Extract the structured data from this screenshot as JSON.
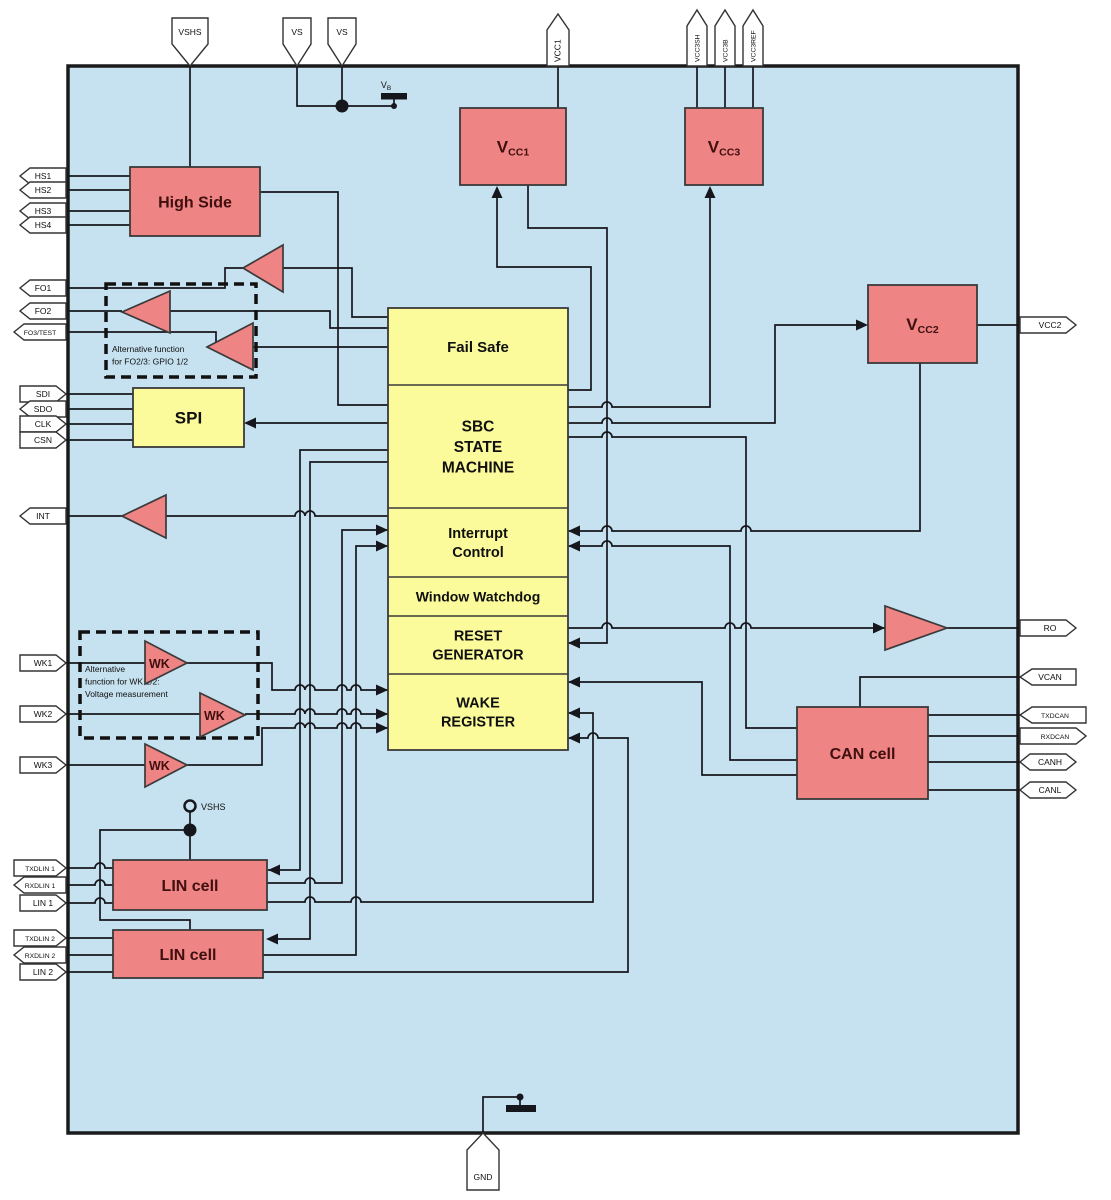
{
  "title": "SBC block diagram",
  "colors": {
    "background": "#ffffff",
    "chip_fill": "#c6e1ef",
    "chip_border": "#1a1a1a",
    "analog_block_fill": "#ee8484",
    "logic_block_fill": "#fbfb9b",
    "block_border": "#3a3a3a",
    "wire": "#16161d",
    "analog_label": "#400f0f",
    "logic_label": "#101010",
    "pin_fill": "#ffffff",
    "pin_border": "#333333"
  },
  "chip": {
    "x": 68,
    "y": 66,
    "w": 950,
    "h": 1067
  },
  "pins": {
    "top": [
      {
        "label": "VSHS",
        "x": 190,
        "tip": "down",
        "small": false
      },
      {
        "label": "VS",
        "x": 297,
        "tip": "down",
        "small": false
      },
      {
        "label": "VS",
        "x": 342,
        "tip": "down",
        "small": false
      },
      {
        "label": "VCC1",
        "x": 558,
        "tip": "up",
        "small": false
      },
      {
        "label": "VCC3SH",
        "x": 697,
        "tip": "up",
        "small": true
      },
      {
        "label": "VCC3B",
        "x": 725,
        "tip": "up",
        "small": true
      },
      {
        "label": "VCC3REF",
        "x": 753,
        "tip": "up",
        "small": true
      }
    ],
    "bottom": [
      {
        "label": "GND",
        "x": 483
      }
    ],
    "left": [
      {
        "label": "HS1",
        "y": 176,
        "tip": "left",
        "small": false
      },
      {
        "label": "HS2",
        "y": 190,
        "tip": "left",
        "small": false
      },
      {
        "label": "HS3",
        "y": 211,
        "tip": "left",
        "small": false
      },
      {
        "label": "HS4",
        "y": 225,
        "tip": "left",
        "small": false
      },
      {
        "label": "FO1",
        "y": 288,
        "tip": "left",
        "small": false
      },
      {
        "label": "FO2",
        "y": 311,
        "tip": "left",
        "small": false
      },
      {
        "label": "FO3/TEST",
        "y": 332,
        "tip": "left",
        "small": true
      },
      {
        "label": "SDI",
        "y": 394,
        "tip": "right",
        "small": false
      },
      {
        "label": "SDO",
        "y": 409,
        "tip": "left",
        "small": false
      },
      {
        "label": "CLK",
        "y": 424,
        "tip": "right",
        "small": false
      },
      {
        "label": "CSN",
        "y": 440,
        "tip": "right",
        "small": false
      },
      {
        "label": "INT",
        "y": 516,
        "tip": "left",
        "small": false
      },
      {
        "label": "WK1",
        "y": 663,
        "tip": "right",
        "small": false
      },
      {
        "label": "WK2",
        "y": 714,
        "tip": "right",
        "small": false
      },
      {
        "label": "WK3",
        "y": 765,
        "tip": "right",
        "small": false
      },
      {
        "label": "TXDLIN 1",
        "y": 868,
        "tip": "right",
        "small": true
      },
      {
        "label": "RXDLIN 1",
        "y": 885,
        "tip": "left",
        "small": true
      },
      {
        "label": "LIN 1",
        "y": 903,
        "tip": "right",
        "small": false
      },
      {
        "label": "TXDLIN 2",
        "y": 938,
        "tip": "right",
        "small": true
      },
      {
        "label": "RXDLIN 2",
        "y": 955,
        "tip": "left",
        "small": true
      },
      {
        "label": "LIN 2",
        "y": 972,
        "tip": "right",
        "small": false
      }
    ],
    "right": [
      {
        "label": "VCC2",
        "y": 325,
        "tip": "right",
        "small": false
      },
      {
        "label": "RO",
        "y": 628,
        "tip": "right",
        "small": false
      },
      {
        "label": "VCAN",
        "y": 677,
        "tip": "left",
        "small": false
      },
      {
        "label": "TXDCAN",
        "y": 715,
        "tip": "left",
        "small": true
      },
      {
        "label": "RXDCAN",
        "y": 736,
        "tip": "right",
        "small": true
      },
      {
        "label": "CANH",
        "y": 762,
        "tip": "both",
        "small": false
      },
      {
        "label": "CANL",
        "y": 790,
        "tip": "both",
        "small": false
      }
    ]
  },
  "blocks": [
    {
      "id": "high-side",
      "label": "High Side",
      "x": 130,
      "y": 167,
      "w": 130,
      "h": 69,
      "type": "analog",
      "fs": 16
    },
    {
      "id": "vcc1",
      "label": "V",
      "sub": "CC1",
      "x": 460,
      "y": 108,
      "w": 106,
      "h": 77,
      "type": "analog",
      "fs": 17
    },
    {
      "id": "vcc3",
      "label": "V",
      "sub": "CC3",
      "x": 685,
      "y": 108,
      "w": 78,
      "h": 77,
      "type": "analog",
      "fs": 17
    },
    {
      "id": "vcc2",
      "label": "V",
      "sub": "CC2",
      "x": 868,
      "y": 285,
      "w": 109,
      "h": 78,
      "type": "analog",
      "fs": 17
    },
    {
      "id": "spi",
      "label": "SPI",
      "x": 133,
      "y": 388,
      "w": 111,
      "h": 59,
      "type": "logic",
      "fs": 17
    },
    {
      "id": "can-cell",
      "label": "CAN cell",
      "x": 797,
      "y": 707,
      "w": 131,
      "h": 92,
      "type": "analog",
      "fs": 16
    },
    {
      "id": "lin-cell-1",
      "label": "LIN cell",
      "x": 113,
      "y": 860,
      "w": 154,
      "h": 50,
      "type": "analog",
      "fs": 16
    },
    {
      "id": "lin-cell-2",
      "label": "LIN cell",
      "x": 113,
      "y": 930,
      "w": 150,
      "h": 48,
      "type": "analog",
      "fs": 16
    }
  ],
  "center_block": {
    "x": 388,
    "y": 308,
    "w": 180,
    "sections": [
      {
        "id": "fail-safe",
        "lines": [
          "Fail Safe"
        ],
        "h": 77,
        "fs": 15
      },
      {
        "id": "sbc-state-machine",
        "lines": [
          "SBC",
          "STATE",
          "MACHINE"
        ],
        "h": 123,
        "fs": 15.5
      },
      {
        "id": "interrupt-control",
        "lines": [
          "Interrupt",
          "Control"
        ],
        "h": 69,
        "fs": 14.5
      },
      {
        "id": "window-watchdog",
        "lines": [
          "Window Watchdog"
        ],
        "h": 39,
        "fs": 14
      },
      {
        "id": "reset-generator",
        "lines": [
          "RESET",
          "GENERATOR"
        ],
        "h": 58,
        "fs": 14.5
      },
      {
        "id": "wake-register",
        "lines": [
          "WAKE",
          "REGISTER"
        ],
        "h": 76,
        "fs": 14.5
      }
    ]
  },
  "triangles": [
    {
      "id": "fo1-driver",
      "pts": [
        [
          283,
          245
        ],
        [
          283,
          292
        ],
        [
          243,
          268
        ]
      ],
      "label": ""
    },
    {
      "id": "fo2-driver",
      "pts": [
        [
          170,
          291
        ],
        [
          170,
          333
        ],
        [
          122,
          312
        ]
      ],
      "label": ""
    },
    {
      "id": "fo3-driver",
      "pts": [
        [
          253,
          323
        ],
        [
          253,
          370
        ],
        [
          207,
          347
        ]
      ],
      "label": ""
    },
    {
      "id": "int-driver",
      "pts": [
        [
          166,
          495
        ],
        [
          166,
          538
        ],
        [
          122,
          516
        ]
      ],
      "label": ""
    },
    {
      "id": "ro-driver",
      "pts": [
        [
          885,
          606
        ],
        [
          885,
          650
        ],
        [
          947,
          628
        ]
      ],
      "label": ""
    },
    {
      "id": "wk1-comparator",
      "pts": [
        [
          145,
          641
        ],
        [
          145,
          684
        ],
        [
          187,
          663
        ]
      ],
      "label": "WK",
      "lx": 149,
      "ly": 668
    },
    {
      "id": "wk2-comparator",
      "pts": [
        [
          200,
          693
        ],
        [
          200,
          737
        ],
        [
          245,
          715
        ]
      ],
      "label": "WK",
      "lx": 204,
      "ly": 720
    },
    {
      "id": "wk3-comparator",
      "pts": [
        [
          145,
          744
        ],
        [
          145,
          787
        ],
        [
          187,
          765
        ]
      ],
      "label": "WK",
      "lx": 149,
      "ly": 770
    }
  ],
  "dashed_boxes": [
    {
      "id": "fo-alt-function",
      "x": 106,
      "y": 284,
      "w": 150,
      "h": 93,
      "lines": [
        "Alternative function",
        "for FO2/3: GPIO 1/2"
      ],
      "tx": 112,
      "ty": 352
    },
    {
      "id": "wk-alt-function",
      "x": 80,
      "y": 632,
      "w": 178,
      "h": 106,
      "lines": [
        "Alternative",
        "function for WK 1/2:",
        "Voltage measurement"
      ],
      "tx": 85,
      "ty": 672
    }
  ],
  "symbols": {
    "battery_label_main": "V",
    "battery_label_sub": "B",
    "vshs_terminal_label": "VSHS"
  }
}
